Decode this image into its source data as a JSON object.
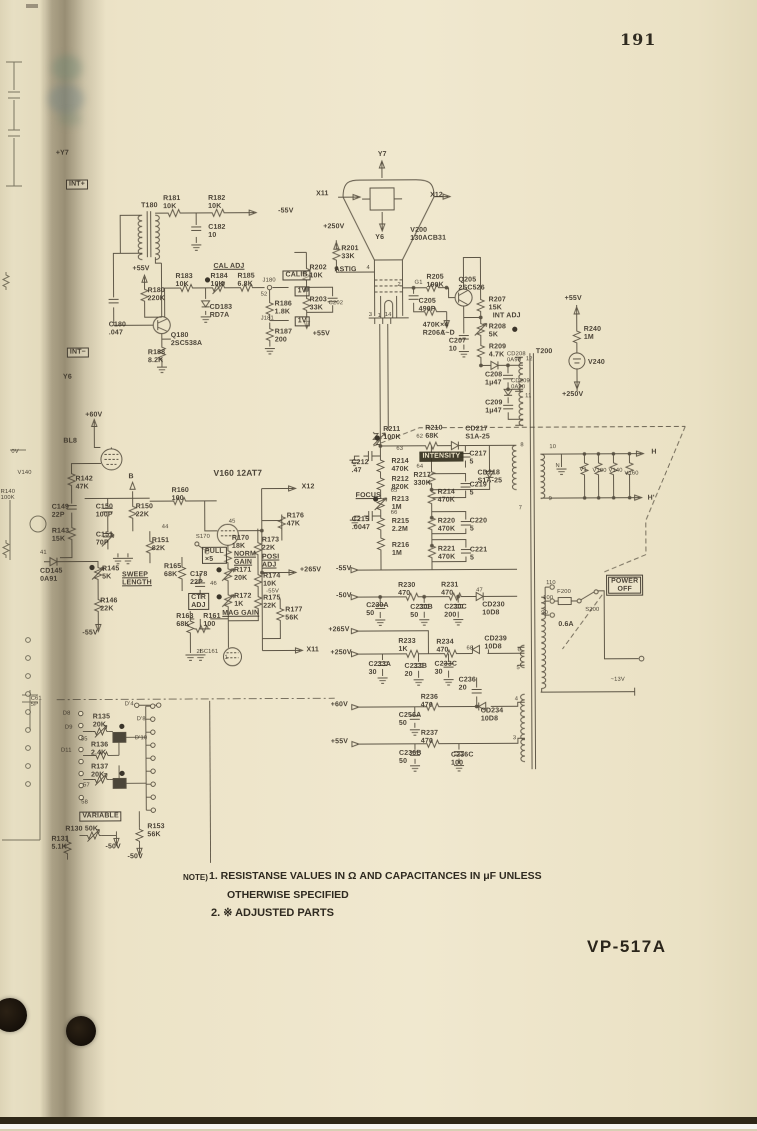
{
  "page": {
    "number": "191",
    "model_label": "VP-517A"
  },
  "notes": {
    "prefix": "NOTE)",
    "item1": "1. RESISTANSE VALUES IN Ω AND CAPACITANCES IN μF UNLESS",
    "item1_cont": "OTHERWISE SPECIFIED",
    "item2": "2. ※ ADJUSTED PARTS"
  },
  "colors": {
    "paper": "#ece3c7",
    "ink": "#4a4234",
    "hole": "#1c150b"
  },
  "schematic": {
    "tube": "V200 130ACB31",
    "labels": [
      {
        "t": "0V",
        "x": 12,
        "y": 447,
        "s": "t"
      },
      {
        "t": "V140",
        "x": 18,
        "y": 468,
        "s": "t"
      },
      {
        "t": "R140\n100K",
        "x": 1,
        "y": 487,
        "s": "t"
      },
      {
        "t": "C61\n5P",
        "x": 30,
        "y": 694,
        "s": "t"
      },
      {
        "t": "+Y7",
        "x": 58,
        "y": 148
      },
      {
        "t": "INT+",
        "x": 68,
        "y": 178,
        "s": "b"
      },
      {
        "t": "INT−",
        "x": 68,
        "y": 346,
        "s": "b"
      },
      {
        "t": "Y6",
        "x": 64,
        "y": 372
      },
      {
        "t": "+60V",
        "x": 86,
        "y": 410
      },
      {
        "t": "BL8",
        "x": 64,
        "y": 436
      },
      {
        "t": "T180",
        "x": 143,
        "y": 201
      },
      {
        "t": "R181\n10K",
        "x": 165,
        "y": 194
      },
      {
        "t": "R182\n10K",
        "x": 210,
        "y": 194
      },
      {
        "t": "-55V",
        "x": 280,
        "y": 207
      },
      {
        "t": "C182\n10",
        "x": 210,
        "y": 223
      },
      {
        "t": "+55V",
        "x": 134,
        "y": 264
      },
      {
        "t": "CAL ADJ",
        "x": 215,
        "y": 262,
        "s": "u"
      },
      {
        "t": "R183\n10K",
        "x": 177,
        "y": 272
      },
      {
        "t": "R184\n10K",
        "x": 212,
        "y": 272
      },
      {
        "t": "R185\n6.8K",
        "x": 239,
        "y": 272
      },
      {
        "t": "J180",
        "x": 264,
        "y": 277,
        "s": "t"
      },
      {
        "t": "CALIB",
        "x": 284,
        "y": 270,
        "s": "b"
      },
      {
        "t": "1V",
        "x": 296,
        "y": 286,
        "s": "b"
      },
      {
        "t": "52",
        "x": 262,
        "y": 291,
        "s": "t"
      },
      {
        "t": "R186\n1.8K",
        "x": 276,
        "y": 300
      },
      {
        "t": "J181",
        "x": 262,
        "y": 315,
        "s": "t"
      },
      {
        "t": "1V",
        "x": 296,
        "y": 316,
        "s": "b"
      },
      {
        "t": "R187\n200",
        "x": 276,
        "y": 328
      },
      {
        "t": "CD183\nRD7A",
        "x": 211,
        "y": 303
      },
      {
        "t": "Q180\n2SC538A",
        "x": 172,
        "y": 331
      },
      {
        "t": "R180\n220K",
        "x": 149,
        "y": 286
      },
      {
        "t": "C180\n.047",
        "x": 110,
        "y": 320
      },
      {
        "t": "R188\n8.2K",
        "x": 149,
        "y": 348
      },
      {
        "t": "Y7",
        "x": 380,
        "y": 151
      },
      {
        "t": "X11",
        "x": 318,
        "y": 190
      },
      {
        "t": "X12",
        "x": 432,
        "y": 192
      },
      {
        "t": "Y6",
        "x": 377,
        "y": 234
      },
      {
        "t": "V200\n130ACB31",
        "x": 412,
        "y": 227
      },
      {
        "t": "+250V",
        "x": 325,
        "y": 223
      },
      {
        "t": "R201\n33K",
        "x": 343,
        "y": 245
      },
      {
        "t": "ASTIG",
        "x": 336,
        "y": 266
      },
      {
        "t": "4",
        "x": 368,
        "y": 265,
        "s": "t"
      },
      {
        "t": "R202\n10K",
        "x": 311,
        "y": 264
      },
      {
        "t": "R203\n33K",
        "x": 311,
        "y": 296
      },
      {
        "t": "C202",
        "x": 330,
        "y": 300,
        "s": "t"
      },
      {
        "t": "+55V",
        "x": 314,
        "y": 330
      },
      {
        "t": "3",
        "x": 370,
        "y": 312,
        "s": "t"
      },
      {
        "t": "1",
        "x": 379,
        "y": 313,
        "s": "t"
      },
      {
        "t": "14",
        "x": 386,
        "y": 312,
        "s": "t"
      },
      {
        "t": "2",
        "x": 399,
        "y": 282,
        "s": "t"
      },
      {
        "t": "G1",
        "x": 416,
        "y": 280,
        "s": "t"
      },
      {
        "t": "R205\n190K",
        "x": 428,
        "y": 274
      },
      {
        "t": "C205\n490P",
        "x": 420,
        "y": 298
      },
      {
        "t": "Σ",
        "x": 443,
        "y": 331,
        "s": "t"
      },
      {
        "t": "470K×4\nR206A~D",
        "x": 424,
        "y": 322
      },
      {
        "t": "Q205\n2SC526",
        "x": 460,
        "y": 277
      },
      {
        "t": "R207\n15K",
        "x": 490,
        "y": 297
      },
      {
        "t": "INT ADJ",
        "x": 494,
        "y": 313
      },
      {
        "t": "R208\n5K",
        "x": 490,
        "y": 324
      },
      {
        "t": "R209\n4.7K",
        "x": 490,
        "y": 344
      },
      {
        "t": "C207\n10",
        "x": 450,
        "y": 338
      },
      {
        "t": "CD208\n0A90",
        "x": 508,
        "y": 352,
        "s": "t"
      },
      {
        "t": "T200",
        "x": 537,
        "y": 349
      },
      {
        "t": "12",
        "x": 527,
        "y": 357,
        "s": "t"
      },
      {
        "t": "C208\n1μ47",
        "x": 486,
        "y": 372
      },
      {
        "t": "CD209\n0A90",
        "x": 512,
        "y": 379,
        "s": "t"
      },
      {
        "t": "11",
        "x": 526,
        "y": 394,
        "s": "t"
      },
      {
        "t": "C209\n1μ47",
        "x": 486,
        "y": 400
      },
      {
        "t": "+55V",
        "x": 566,
        "y": 296
      },
      {
        "t": "R240\n1M",
        "x": 585,
        "y": 327
      },
      {
        "t": "V240",
        "x": 589,
        "y": 360
      },
      {
        "t": "+250V",
        "x": 563,
        "y": 392
      },
      {
        "t": "R211\n100K",
        "x": 384,
        "y": 426
      },
      {
        "t": "62",
        "x": 417,
        "y": 434,
        "s": "t"
      },
      {
        "t": "R210\n68K",
        "x": 426,
        "y": 425
      },
      {
        "t": "CD217\nS1A-25",
        "x": 466,
        "y": 426
      },
      {
        "t": "63",
        "x": 397,
        "y": 446,
        "s": "t"
      },
      {
        "t": "INTENSITY",
        "x": 420,
        "y": 452,
        "s": "bi"
      },
      {
        "t": "C217\n5",
        "x": 470,
        "y": 451
      },
      {
        "t": "C212\n.47",
        "x": 352,
        "y": 459
      },
      {
        "t": "R214\n470K",
        "x": 392,
        "y": 458
      },
      {
        "t": "64",
        "x": 417,
        "y": 464,
        "s": "t"
      },
      {
        "t": "R217\n330K",
        "x": 414,
        "y": 472
      },
      {
        "t": "R212\n820K",
        "x": 392,
        "y": 476
      },
      {
        "t": "CD218\nS1A-25",
        "x": 478,
        "y": 470
      },
      {
        "t": "C219\n5",
        "x": 470,
        "y": 482
      },
      {
        "t": "R214\n470K",
        "x": 438,
        "y": 489
      },
      {
        "t": "FOCUS",
        "x": 356,
        "y": 492,
        "s": "u"
      },
      {
        "t": "65",
        "x": 391,
        "y": 488,
        "s": "t"
      },
      {
        "t": "R213\n1M",
        "x": 392,
        "y": 496
      },
      {
        "t": "66",
        "x": 391,
        "y": 510,
        "s": "t"
      },
      {
        "t": "C215\n.0047",
        "x": 352,
        "y": 516
      },
      {
        "t": "R215\n2.2M",
        "x": 392,
        "y": 518
      },
      {
        "t": "R220\n470K",
        "x": 438,
        "y": 518
      },
      {
        "t": "C220\n5",
        "x": 470,
        "y": 518
      },
      {
        "t": "R216\n1M",
        "x": 392,
        "y": 542
      },
      {
        "t": "R221\n470K",
        "x": 438,
        "y": 546
      },
      {
        "t": "C221\n5",
        "x": 470,
        "y": 547
      },
      {
        "t": "8",
        "x": 521,
        "y": 443,
        "s": "t"
      },
      {
        "t": "7",
        "x": 519,
        "y": 506,
        "s": "t"
      },
      {
        "t": "R142\n47K",
        "x": 76,
        "y": 474
      },
      {
        "t": "C149\n22P",
        "x": 52,
        "y": 502
      },
      {
        "t": "C150\n100P",
        "x": 96,
        "y": 502
      },
      {
        "t": "R150\n22K",
        "x": 136,
        "y": 502
      },
      {
        "t": "R143\n15K",
        "x": 52,
        "y": 526
      },
      {
        "t": "C151\n70P",
        "x": 96,
        "y": 530
      },
      {
        "t": "B",
        "x": 129,
        "y": 472
      },
      {
        "t": "R160\n100",
        "x": 172,
        "y": 486
      },
      {
        "t": "V160 12AT7",
        "x": 214,
        "y": 468,
        "s": "m"
      },
      {
        "t": "44",
        "x": 162,
        "y": 523,
        "s": "t"
      },
      {
        "t": "45",
        "x": 229,
        "y": 518,
        "s": "t"
      },
      {
        "t": "R151\n82K",
        "x": 152,
        "y": 536
      },
      {
        "t": "41",
        "x": 40,
        "y": 548,
        "s": "t"
      },
      {
        "t": "CD145\n0A91",
        "x": 40,
        "y": 566
      },
      {
        "t": "R145\n5K",
        "x": 102,
        "y": 564
      },
      {
        "t": "SWEEP\nLENGTH",
        "x": 122,
        "y": 570,
        "s": "u"
      },
      {
        "t": "R146\n22K",
        "x": 100,
        "y": 596
      },
      {
        "t": "-55V",
        "x": 82,
        "y": 628
      },
      {
        "t": "R165\n68K",
        "x": 164,
        "y": 562
      },
      {
        "t": "C178\n22P",
        "x": 190,
        "y": 570
      },
      {
        "t": "S170",
        "x": 196,
        "y": 533,
        "s": "t"
      },
      {
        "t": "PULL\n×5",
        "x": 202,
        "y": 546,
        "s": "b"
      },
      {
        "t": "R170\n18K",
        "x": 232,
        "y": 534
      },
      {
        "t": "NORM\nGAIN",
        "x": 234,
        "y": 550,
        "s": "u"
      },
      {
        "t": "46",
        "x": 210,
        "y": 580,
        "s": "t"
      },
      {
        "t": "CTR\nADJ",
        "x": 188,
        "y": 592,
        "s": "b"
      },
      {
        "t": "R171\n20K",
        "x": 234,
        "y": 566
      },
      {
        "t": "R172\n1K",
        "x": 234,
        "y": 592
      },
      {
        "t": "MAG GAIN",
        "x": 222,
        "y": 609,
        "s": "u"
      },
      {
        "t": "R173\n22K",
        "x": 262,
        "y": 536
      },
      {
        "t": "POSI\nADJ",
        "x": 262,
        "y": 553,
        "s": "u"
      },
      {
        "t": "R174\n10K",
        "x": 263,
        "y": 572
      },
      {
        "t": "-55V",
        "x": 266,
        "y": 588,
        "s": "t"
      },
      {
        "t": "R175\n22K",
        "x": 263,
        "y": 594
      },
      {
        "t": "R176\n47K",
        "x": 287,
        "y": 512
      },
      {
        "t": "R177\n56K",
        "x": 285,
        "y": 606
      },
      {
        "t": "R163\n68K",
        "x": 176,
        "y": 612
      },
      {
        "t": "R161\n100",
        "x": 203,
        "y": 612
      },
      {
        "t": "2SC161",
        "x": 196,
        "y": 648,
        "s": "t"
      },
      {
        "t": "1",
        "x": 224,
        "y": 654,
        "s": "t"
      },
      {
        "t": "X12",
        "x": 302,
        "y": 483
      },
      {
        "t": "+265V",
        "x": 300,
        "y": 566
      },
      {
        "t": "X11",
        "x": 306,
        "y": 646
      },
      {
        "t": "-55V",
        "x": 336,
        "y": 565
      },
      {
        "t": "-50V",
        "x": 336,
        "y": 592
      },
      {
        "t": "+265V",
        "x": 328,
        "y": 626
      },
      {
        "t": "+250V",
        "x": 330,
        "y": 649
      },
      {
        "t": "+60V",
        "x": 330,
        "y": 701
      },
      {
        "t": "+55V",
        "x": 330,
        "y": 738
      },
      {
        "t": "R230\n470",
        "x": 398,
        "y": 582
      },
      {
        "t": "R231\n470",
        "x": 441,
        "y": 582
      },
      {
        "t": "47",
        "x": 476,
        "y": 588,
        "s": "t"
      },
      {
        "t": "CD230\n10D8",
        "x": 482,
        "y": 602
      },
      {
        "t": "C230A\n50",
        "x": 366,
        "y": 602
      },
      {
        "t": "C230B\n50",
        "x": 410,
        "y": 604
      },
      {
        "t": "C230C\n200",
        "x": 444,
        "y": 604
      },
      {
        "t": "R233\n1K",
        "x": 398,
        "y": 638
      },
      {
        "t": "R234\n470",
        "x": 436,
        "y": 639
      },
      {
        "t": "68",
        "x": 466,
        "y": 646,
        "s": "t"
      },
      {
        "t": "CD239\n10D8",
        "x": 484,
        "y": 636
      },
      {
        "t": "C233A\n30",
        "x": 368,
        "y": 661
      },
      {
        "t": "C233B\n20",
        "x": 404,
        "y": 663
      },
      {
        "t": "C233C\n30",
        "x": 434,
        "y": 661
      },
      {
        "t": "C236\n20",
        "x": 458,
        "y": 677
      },
      {
        "t": "R236\n470",
        "x": 420,
        "y": 694
      },
      {
        "t": "4",
        "x": 514,
        "y": 697,
        "s": "t"
      },
      {
        "t": "CD234\n10D8",
        "x": 480,
        "y": 708
      },
      {
        "t": "C256A\n50",
        "x": 398,
        "y": 712
      },
      {
        "t": "R237\n470",
        "x": 420,
        "y": 730
      },
      {
        "t": "C236B\n50",
        "x": 398,
        "y": 750
      },
      {
        "t": "C236C\n100",
        "x": 450,
        "y": 752
      },
      {
        "t": "3",
        "x": 512,
        "y": 736,
        "s": "t"
      },
      {
        "t": "6",
        "x": 517,
        "y": 648,
        "s": "t"
      },
      {
        "t": "5",
        "x": 516,
        "y": 666,
        "s": "t"
      },
      {
        "t": "10",
        "x": 550,
        "y": 445,
        "s": "t"
      },
      {
        "t": "N",
        "x": 556,
        "y": 464,
        "s": "t"
      },
      {
        "t": "V1",
        "x": 580,
        "y": 468,
        "s": "t"
      },
      {
        "t": "V100",
        "x": 593,
        "y": 469,
        "s": "t"
      },
      {
        "t": "V140",
        "x": 609,
        "y": 469,
        "s": "t"
      },
      {
        "t": "V160",
        "x": 625,
        "y": 472,
        "s": "t"
      },
      {
        "t": "H",
        "x": 652,
        "y": 450
      },
      {
        "t": "H'",
        "x": 648,
        "y": 496
      },
      {
        "t": "9",
        "x": 549,
        "y": 497,
        "s": "t"
      },
      {
        "t": "110",
        "x": 546,
        "y": 581,
        "s": "t"
      },
      {
        "t": "100",
        "x": 543,
        "y": 596,
        "s": "t"
      },
      {
        "t": "90",
        "x": 541,
        "y": 611,
        "s": "t"
      },
      {
        "t": "F200",
        "x": 557,
        "y": 590,
        "s": "t"
      },
      {
        "t": "S200",
        "x": 585,
        "y": 608,
        "s": "t"
      },
      {
        "t": "0.6A",
        "x": 558,
        "y": 622
      },
      {
        "t": "POWER\nOFF",
        "x": 608,
        "y": 578,
        "s": "bb"
      },
      {
        "t": "~13V",
        "x": 610,
        "y": 678,
        "s": "t"
      },
      {
        "t": "D'4",
        "x": 124,
        "y": 700,
        "s": "t"
      },
      {
        "t": "D'8",
        "x": 136,
        "y": 715,
        "s": "t"
      },
      {
        "t": "D'10",
        "x": 134,
        "y": 734,
        "s": "t"
      },
      {
        "t": "D8",
        "x": 62,
        "y": 709,
        "s": "t"
      },
      {
        "t": "D9",
        "x": 64,
        "y": 723,
        "s": "t"
      },
      {
        "t": "R135\n20K",
        "x": 92,
        "y": 712
      },
      {
        "t": "55",
        "x": 80,
        "y": 735,
        "s": "t"
      },
      {
        "t": "R136\n2.4K",
        "x": 90,
        "y": 740
      },
      {
        "t": "D11",
        "x": 60,
        "y": 746,
        "s": "t"
      },
      {
        "t": "R137\n20K",
        "x": 90,
        "y": 762
      },
      {
        "t": "57",
        "x": 82,
        "y": 781,
        "s": "t"
      },
      {
        "t": "58",
        "x": 80,
        "y": 798,
        "s": "t"
      },
      {
        "t": "VARIABLE",
        "x": 78,
        "y": 810,
        "s": "b"
      },
      {
        "t": "R130 50K",
        "x": 64,
        "y": 824
      },
      {
        "t": "R131\n5.1K",
        "x": 50,
        "y": 834
      },
      {
        "t": "-50V",
        "x": 104,
        "y": 842
      },
      {
        "t": "R153\n56K",
        "x": 146,
        "y": 822
      },
      {
        "t": "-50V",
        "x": 126,
        "y": 852
      }
    ]
  }
}
